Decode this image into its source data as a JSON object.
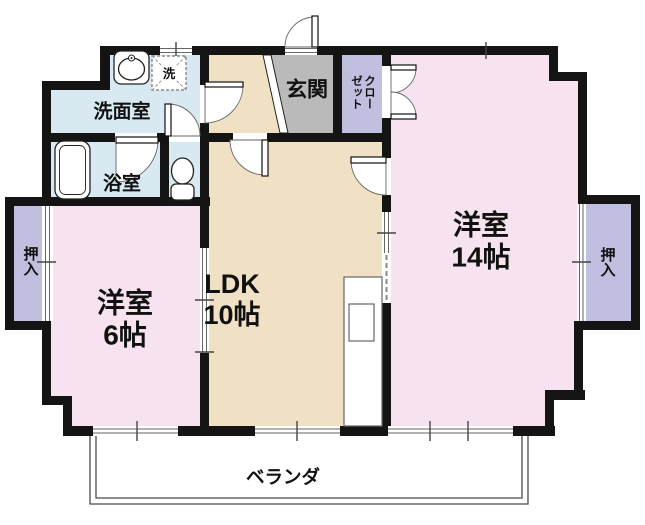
{
  "floorplan": {
    "rooms": {
      "washroom": {
        "label": "洗面室"
      },
      "bathroom": {
        "label": "浴室"
      },
      "laundry": {
        "label": "洗"
      },
      "genkan": {
        "label": "玄関"
      },
      "closet": {
        "label": "クローゼット",
        "label_col_right": "クロー",
        "label_col_left": "ゼット"
      },
      "western14": {
        "label": "洋室",
        "size": "14帖"
      },
      "western6": {
        "label": "洋室",
        "size": "6帖"
      },
      "ldk": {
        "label": "LDK",
        "size": "10帖"
      },
      "oshiire_left": {
        "label": "押入"
      },
      "oshiire_right": {
        "label": "押入"
      },
      "veranda": {
        "label": "ベランダ"
      }
    },
    "colors": {
      "room_pink": "#f7e3ef",
      "room_beige": "#f1e1c4",
      "wet_blue": "#d8e9f2",
      "storage_purple": "#c0bfe0",
      "entry_gray": "#bababa",
      "wall": "#141414"
    }
  }
}
